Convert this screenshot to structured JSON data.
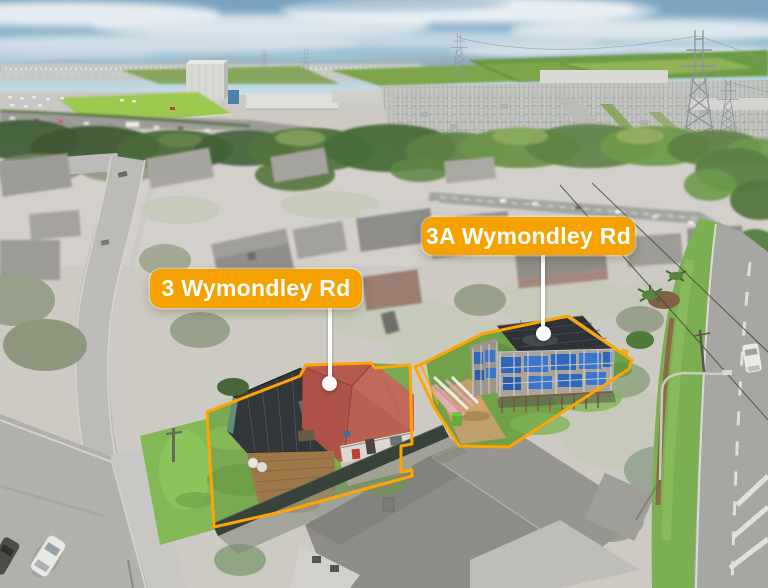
{
  "callouts": [
    {
      "id": "3",
      "label": "3 Wymondley Rd"
    },
    {
      "id": "3a",
      "label": "3A Wymondley Rd"
    }
  ],
  "colors": {
    "callout_bg": "#F5A201",
    "callout_text": "#FFFFFF",
    "boundary": "#FFA400",
    "leader": "#FFFFFF"
  }
}
